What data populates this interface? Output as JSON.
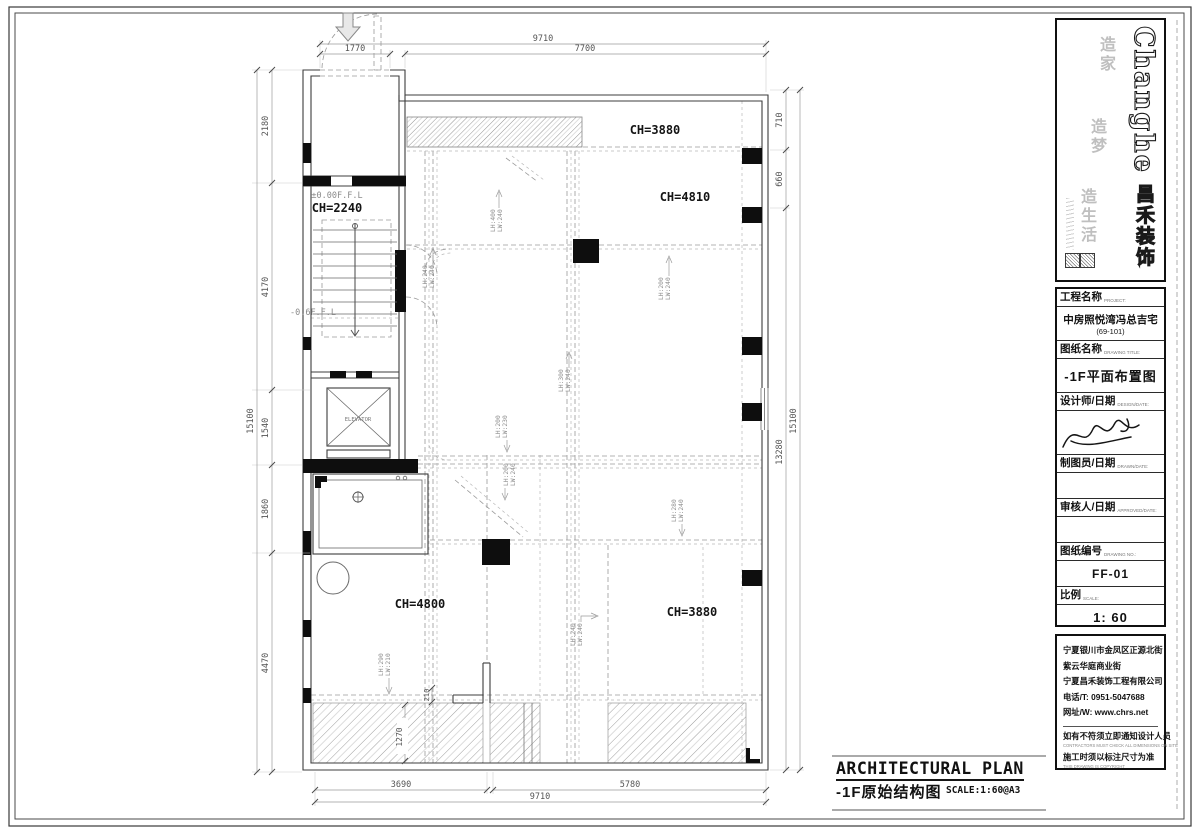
{
  "plan": {
    "rooms": {
      "ch_top": "CH=3880",
      "ch_right": "CH=4810",
      "ch_stair": "CH=2240",
      "ch_bottom_left": "CH=4800",
      "ch_bottom_right": "CH=3880"
    },
    "levels": {
      "ground": "±0.00F.F.L",
      "lower": "-0.6F.F.L"
    },
    "elevator_label": "ELEVATOR",
    "beams": [
      {
        "l1": "LH:400",
        "l2": "LW:240"
      },
      {
        "l1": "LH:240",
        "l2": "LW:240"
      },
      {
        "l1": "LH:200",
        "l2": "LW:240"
      },
      {
        "l1": "LH:300",
        "l2": "LW:240"
      },
      {
        "l1": "LH:200",
        "l2": "LW:230"
      },
      {
        "l1": "LH:200",
        "l2": "LW:240"
      },
      {
        "l1": "LH:280",
        "l2": "LW:240"
      },
      {
        "l1": "LH:240",
        "l2": "LW:240"
      },
      {
        "l1": "LH:290",
        "l2": "LW:210"
      }
    ],
    "dims": {
      "top": [
        "1770",
        "7700",
        "9710"
      ],
      "left": [
        "2180",
        "4170",
        "1540",
        "1860",
        "4470",
        "15100"
      ],
      "right": [
        "710",
        "660",
        "13280",
        "15100"
      ],
      "bottom": [
        "3690",
        "5780",
        "9710"
      ],
      "inner": [
        "1270",
        "210"
      ]
    }
  },
  "title_block": {
    "brand": {
      "en": "Changhe",
      "cn": "昌禾装饰",
      "slogan": [
        "造家",
        "造梦",
        "造生活"
      ]
    },
    "fields": [
      {
        "label": "工程名称",
        "label_en": "PROJECT:",
        "value": "中房照悦湾冯总吉宅",
        "value2": "(69-101)"
      },
      {
        "label": "图纸名称",
        "label_en": "DRAWING TITLE:",
        "value": "-1F平面布置图"
      },
      {
        "label": "设计师/日期",
        "label_en": "DESIGN/DATE:"
      },
      {
        "label": "制图员/日期",
        "label_en": "DRAWN/DATE:"
      },
      {
        "label": "审核人/日期",
        "label_en": "APPROVED/DATE:"
      },
      {
        "label": "图纸编号",
        "label_en": "DRAWING NO.:",
        "value": "FF-01"
      },
      {
        "label": "比例",
        "label_en": "SCALE:",
        "value": "1: 60"
      }
    ],
    "address": [
      "宁夏银川市金凤区正源北街",
      "紫云华庭商业街",
      "宁夏昌禾装饰工程有限公司",
      "电话/T: 0951-5047688",
      "网址/W: www.chrs.net"
    ],
    "notes": [
      {
        "cn": "如有不符须立即通知设计人员",
        "en": "CONTRACTORS MUST CHECK ALL DIMENSIONS ON SITE"
      },
      {
        "cn": "施工时须以标注尺寸为准",
        "en": "THIS DRAWING IS COPYRIGHT"
      }
    ]
  },
  "footer": {
    "title_en": "ARCHITECTURAL PLAN",
    "title_cn": "-1F原始结构图",
    "scale_note": "SCALE:1:60@A3"
  }
}
